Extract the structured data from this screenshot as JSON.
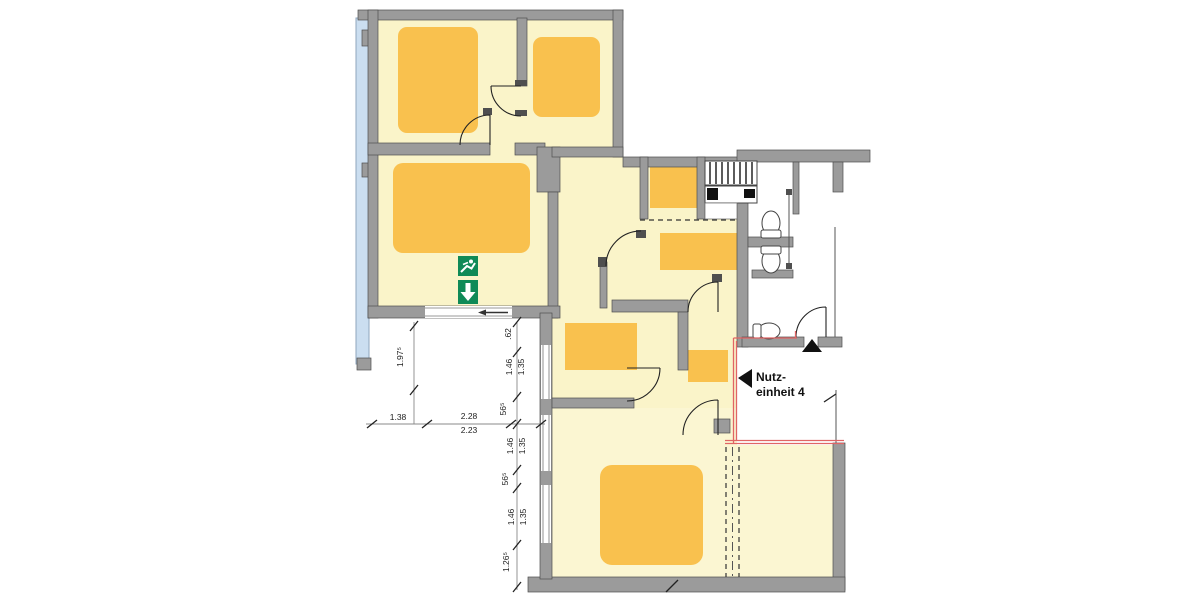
{
  "unit_label": {
    "line1": "Nutz-",
    "line2": "einheit 4"
  },
  "dimensions": [
    {
      "t": "1.97⁵",
      "x": 403,
      "y": 357,
      "r": -90
    },
    {
      "t": "1.38",
      "x": 398,
      "y": 420,
      "r": 0
    },
    {
      "t": "2.28",
      "x": 469,
      "y": 419,
      "r": 0
    },
    {
      "t": "2.23",
      "x": 469,
      "y": 433,
      "r": 0
    },
    {
      "t": ".62",
      "x": 511,
      "y": 334,
      "r": -90
    },
    {
      "t": "1.46",
      "x": 512,
      "y": 367,
      "r": -90
    },
    {
      "t": "1.35",
      "x": 524,
      "y": 367,
      "r": -90
    },
    {
      "t": "56⁵",
      "x": 506,
      "y": 409,
      "r": -90
    },
    {
      "t": "1.46",
      "x": 513,
      "y": 446,
      "r": -90
    },
    {
      "t": "1.35",
      "x": 525,
      "y": 446,
      "r": -90
    },
    {
      "t": "56⁵",
      "x": 508,
      "y": 479,
      "r": -90
    },
    {
      "t": "1.46",
      "x": 514,
      "y": 517,
      "r": -90
    },
    {
      "t": "1.35",
      "x": 526,
      "y": 517,
      "r": -90
    },
    {
      "t": "1.26⁵",
      "x": 509,
      "y": 562,
      "r": -90
    }
  ],
  "icons": {
    "exit_sign_top": "running-man-exit-icon",
    "exit_sign_bottom": "down-arrow-icon",
    "entrance_marker": "entrance-triangle-icon",
    "unit_marker": "left-triangle-icon",
    "window_arrow": "left-arrow-icon"
  },
  "colors": {
    "room": "#FAF4C9",
    "room_bottom": "#FBF6D2",
    "furniture": "#F9C14E",
    "wall": "#9B9B9B",
    "wall_dark": "#4F4F4F",
    "balcony": "#CBDEF0",
    "exit_green": "#0F8A57",
    "boundary_red": "#E06565",
    "background": "#FFFFFF"
  }
}
